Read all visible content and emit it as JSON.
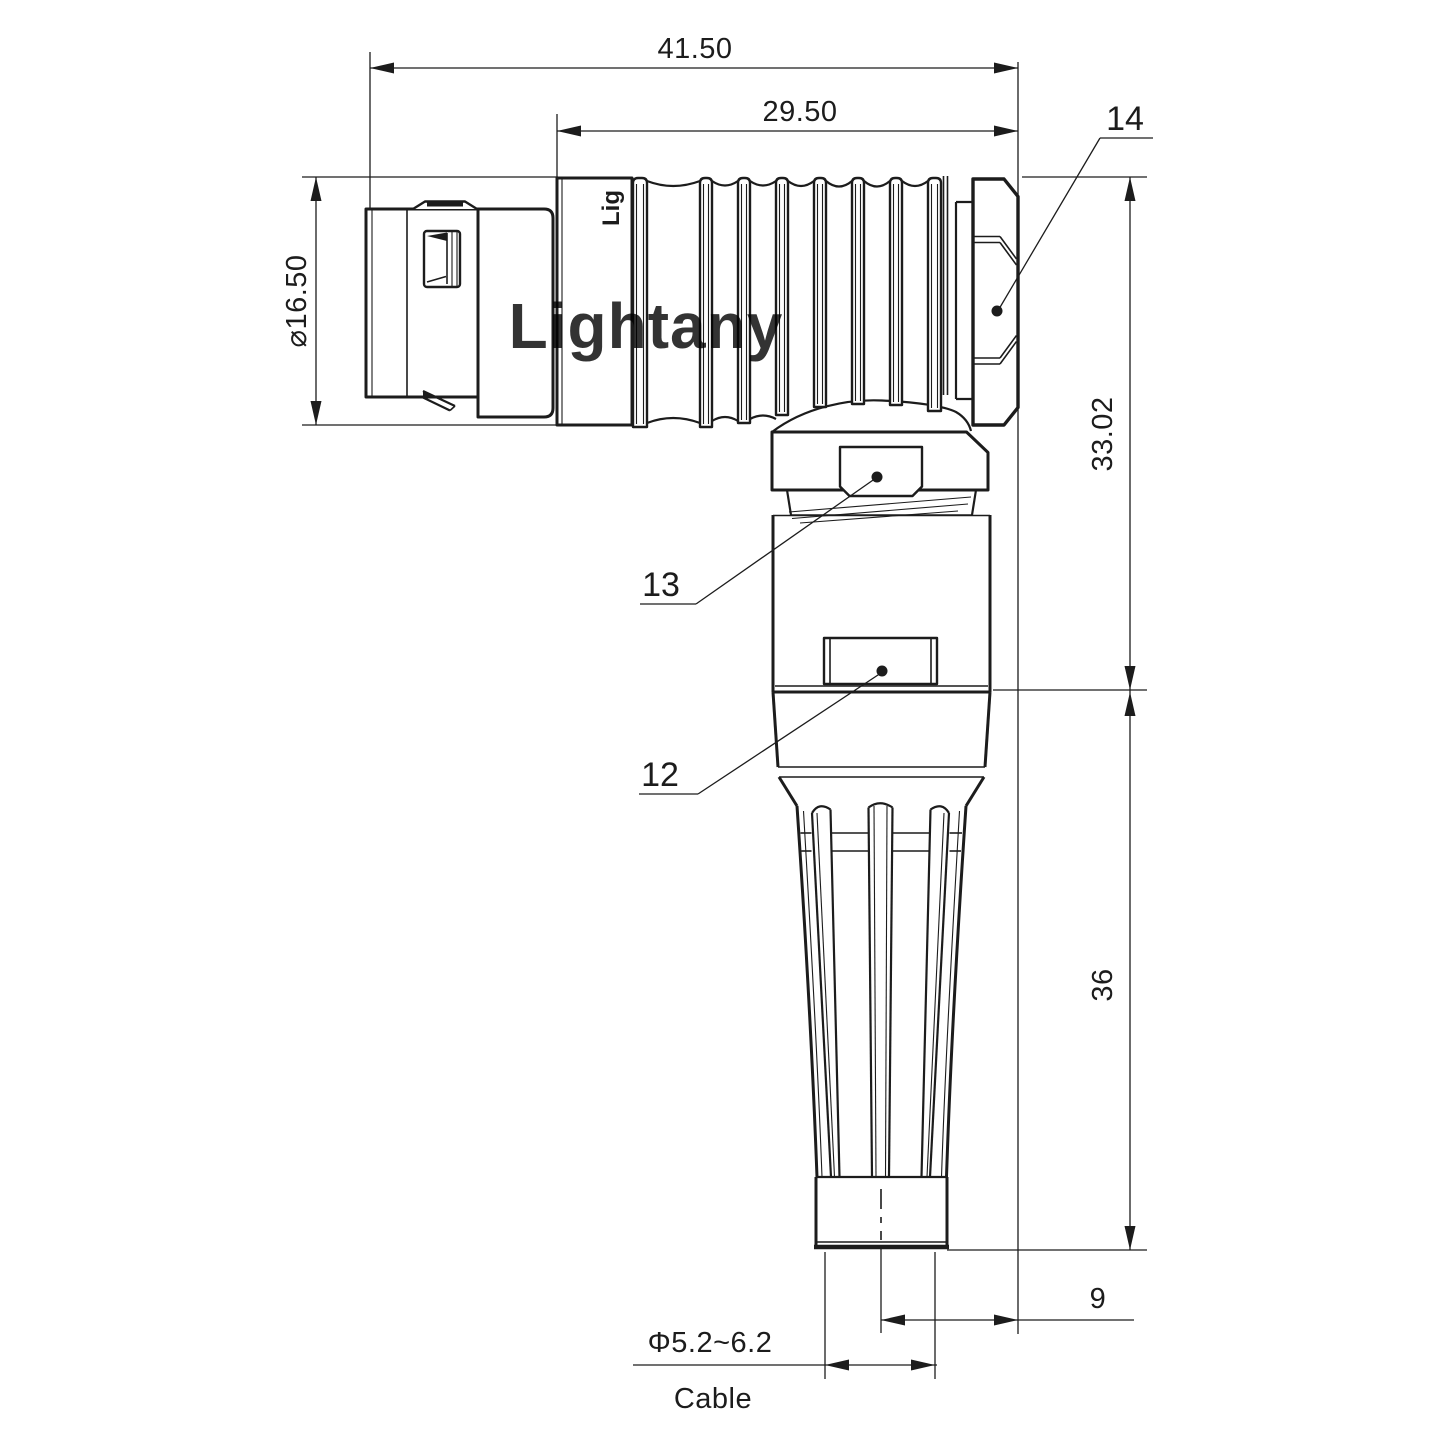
{
  "drawing": {
    "watermark": {
      "text": "Lightany",
      "color": "#f2c6c9"
    },
    "body_marking": "Lig",
    "colors": {
      "line": "#1c1c1c",
      "background": "#ffffff"
    },
    "dimensions": {
      "overall_length": "41.50",
      "rear_body_length": "29.50",
      "front_diameter": "⌀16.50",
      "elbow_height": "33.02",
      "boot_height": "36",
      "axis_offset": "9",
      "cable_diameter": "Φ5.2~6.2",
      "cable_label": "Cable"
    },
    "part_labels": {
      "hex_nut": "14",
      "gland_collar": "13",
      "housing_body": "12"
    }
  }
}
